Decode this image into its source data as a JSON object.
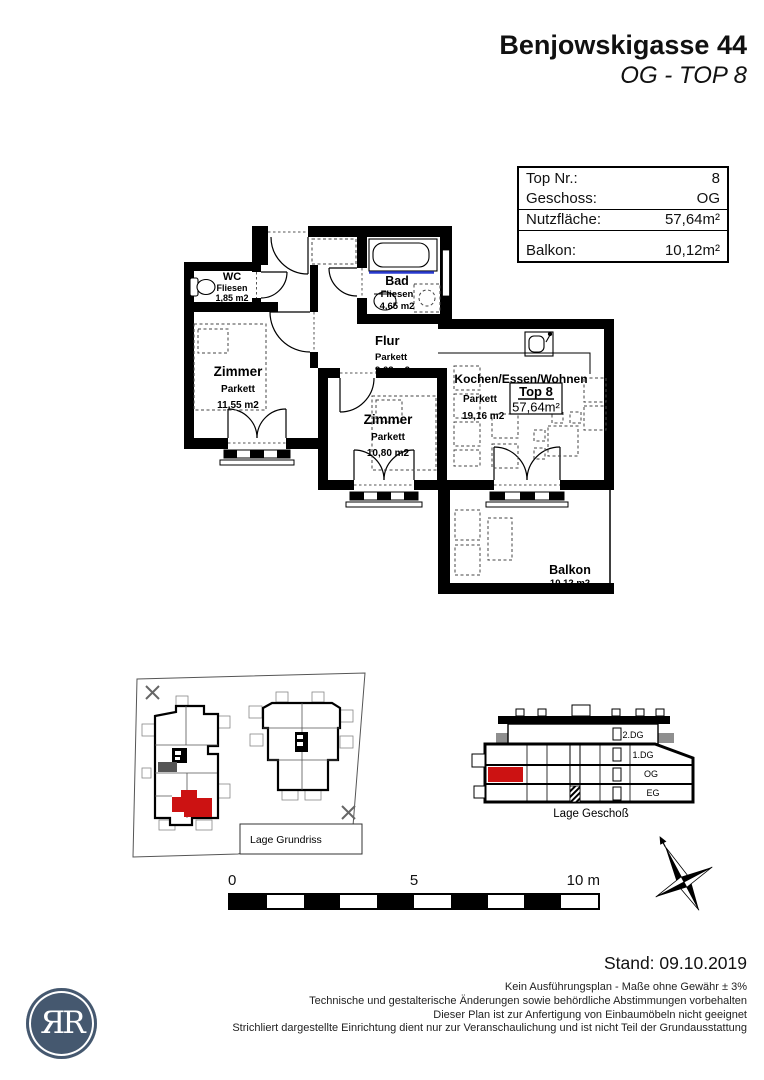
{
  "title": {
    "building": "Benjowskigasse 44",
    "unit": "OG - TOP 8"
  },
  "info_table": {
    "rows": [
      {
        "label": "Top Nr.:",
        "value": "8"
      },
      {
        "label": "Geschoss:",
        "value": "OG"
      },
      {
        "label": "Nutzfläche:",
        "value": "57,64m²"
      },
      {
        "label": "Balkon:",
        "value": "10,12m²"
      }
    ]
  },
  "floorplan": {
    "wc": {
      "name": "WC",
      "surface": "Fliesen",
      "area": "1,85 m2"
    },
    "bad": {
      "name": "Bad",
      "surface": "Fliesen",
      "area": "4,65 m2"
    },
    "flur": {
      "name": "Flur",
      "surface": "Parkett",
      "area": "9,63 m2"
    },
    "zimmer1": {
      "name": "Zimmer",
      "surface": "Parkett",
      "area": "11,55 m2"
    },
    "zimmer2": {
      "name": "Zimmer",
      "surface": "Parkett",
      "area": "10,80 m2"
    },
    "wohnen": {
      "name": "Kochen/Essen/Wohnen",
      "surface": "Parkett",
      "area": "19,16 m2"
    },
    "balkon": {
      "name": "Balkon",
      "area": "10,12 m2"
    },
    "badge": {
      "top": "Top 8",
      "area": "57,64m²"
    }
  },
  "site_plan": {
    "caption": "Lage Grundriss"
  },
  "section": {
    "caption": "Lage Geschoß",
    "floors": {
      "f2dg": "2.DG",
      "f1dg": "1.DG",
      "og": "OG",
      "eg": "EG"
    }
  },
  "scale_bar": {
    "tick0": "0",
    "tick5": "5",
    "tick10": "10 m"
  },
  "footer": {
    "stand": "Stand: 09.10.2019",
    "notes": [
      "Kein Ausführungsplan - Maße ohne Gewähr ± 3%",
      "Technische und gestalterische Änderungen sowie behördliche Abstimmungen vorbehalten",
      "Dieser Plan ist zur Anfertigung von Einbaumöbeln nicht geeignet",
      "Strichliert dargestellte Einrichtung dient nur zur Veranschaulichung und ist nicht Teil der Grundausstattung"
    ],
    "logo_monogram": "ЯR"
  },
  "colors": {
    "highlight": "#cc1212",
    "logo": "#45586f",
    "tub_line": "#2a3bd0"
  }
}
